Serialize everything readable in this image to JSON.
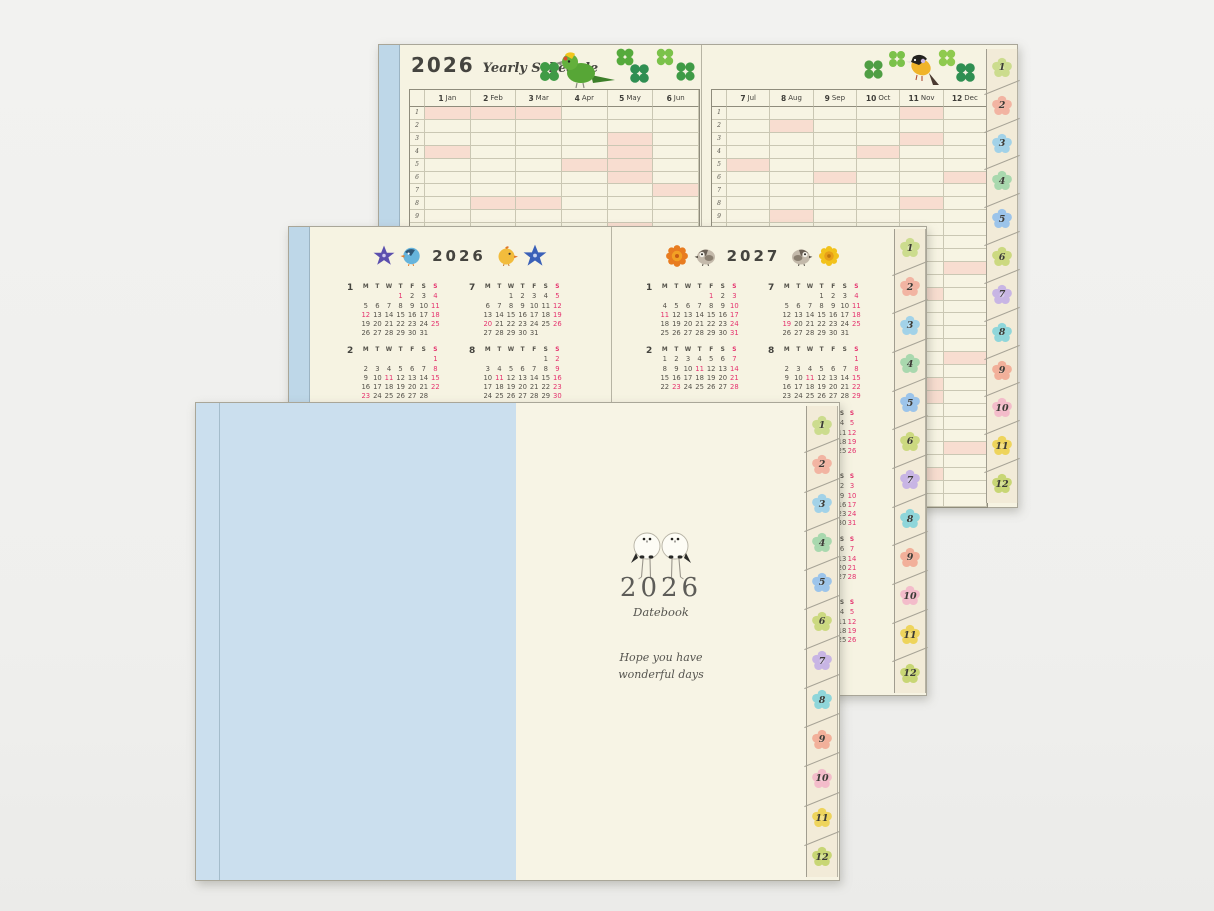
{
  "colors": {
    "background": "#f0f0ee",
    "page_cream": "#f6f3e2",
    "cover_blue": "#cbdfee",
    "spine_blue": "#bed7e8",
    "tab_cream": "#f2ebd8",
    "pink_highlight": "#f8ddd0",
    "red_text": "#e5326e",
    "dark_text": "#45443f"
  },
  "yearly": {
    "year": "2026",
    "title": "Yearly Schedule",
    "rows": 31,
    "left_months": [
      {
        "num": "1",
        "name": "Jan"
      },
      {
        "num": "2",
        "name": "Feb"
      },
      {
        "num": "3",
        "name": "Mar"
      },
      {
        "num": "4",
        "name": "Apr"
      },
      {
        "num": "5",
        "name": "May"
      },
      {
        "num": "6",
        "name": "Jun"
      }
    ],
    "right_months": [
      {
        "num": "7",
        "name": "Jul"
      },
      {
        "num": "8",
        "name": "Aug"
      },
      {
        "num": "9",
        "name": "Sep"
      },
      {
        "num": "10",
        "name": "Oct"
      },
      {
        "num": "11",
        "name": "Nov"
      },
      {
        "num": "12",
        "name": "Dec"
      }
    ],
    "pink_days": {
      "1": [
        1,
        4,
        11,
        12,
        18,
        25
      ],
      "2": [
        1,
        8,
        11,
        15,
        22,
        23
      ],
      "3": [
        1,
        8,
        15,
        20,
        22,
        29
      ],
      "4": [
        5,
        12,
        19,
        26,
        29
      ],
      "5": [
        3,
        4,
        5,
        6,
        10,
        17,
        24,
        31
      ],
      "6": [
        7,
        14,
        21,
        28
      ],
      "7": [
        5,
        12,
        19,
        20,
        26
      ],
      "8": [
        2,
        9,
        11,
        16,
        23,
        30
      ],
      "9": [
        6,
        13,
        20,
        21,
        22,
        23,
        27
      ],
      "10": [
        4,
        11,
        12,
        18,
        25
      ],
      "11": [
        1,
        3,
        8,
        15,
        22,
        23,
        29
      ],
      "12": [
        6,
        13,
        20,
        27
      ]
    }
  },
  "tabs": {
    "labels": [
      "1",
      "2",
      "3",
      "4",
      "5",
      "6",
      "7",
      "8",
      "9",
      "10",
      "11",
      "12"
    ],
    "colors": [
      "#ccdc8e",
      "#f2b4a2",
      "#a2d2e8",
      "#a9d8ae",
      "#9cc4ea",
      "#ccd980",
      "#c8b5e4",
      "#8fd6da",
      "#f2b09a",
      "#f3bcca",
      "#eed45c",
      "#c8d675"
    ]
  },
  "minical": {
    "weekday_header": [
      "M",
      "T",
      "W",
      "T",
      "F",
      "S",
      "S"
    ],
    "left_year": "2026",
    "right_year": "2027",
    "left_months": [
      {
        "num": "1",
        "start": 3,
        "days": 31,
        "red": [
          1,
          4,
          11,
          12,
          18,
          25
        ]
      },
      {
        "num": "7",
        "start": 2,
        "days": 31,
        "red": [
          5,
          12,
          19,
          20,
          26
        ]
      },
      {
        "num": "2",
        "start": 6,
        "days": 28,
        "red": [
          1,
          8,
          11,
          15,
          22,
          23
        ]
      },
      {
        "num": "8",
        "start": 5,
        "days": 31,
        "red": [
          2,
          9,
          11,
          16,
          23,
          30
        ]
      }
    ],
    "right_months": [
      {
        "num": "1",
        "start": 4,
        "days": 31,
        "red": [
          1,
          3,
          10,
          11,
          17,
          24,
          31
        ]
      },
      {
        "num": "7",
        "start": 3,
        "days": 31,
        "red": [
          4,
          11,
          18,
          19,
          25
        ]
      },
      {
        "num": "2",
        "start": 0,
        "days": 28,
        "red": [
          7,
          11,
          14,
          21,
          23,
          28
        ]
      },
      {
        "num": "8",
        "start": 6,
        "days": 31,
        "red": [
          1,
          8,
          11,
          15,
          22,
          29
        ]
      }
    ],
    "edge_columns": [
      {
        "sat": [
          4,
          11,
          18,
          25
        ],
        "sun": [
          5,
          12,
          19,
          26
        ]
      },
      {
        "sat": [
          2,
          9,
          16,
          23,
          30
        ],
        "sun": [
          3,
          10,
          17,
          24,
          31
        ]
      },
      {
        "sat": [
          6,
          13,
          20,
          27
        ],
        "sun": [
          7,
          14,
          21,
          28
        ]
      },
      {
        "sat": [
          4,
          11,
          18,
          25
        ],
        "sun": [
          5,
          12,
          19,
          26
        ]
      }
    ]
  },
  "cover": {
    "year": "2026",
    "subtitle": "Datebook",
    "message_line1": "Hope you have",
    "message_line2": "wonderful days"
  }
}
